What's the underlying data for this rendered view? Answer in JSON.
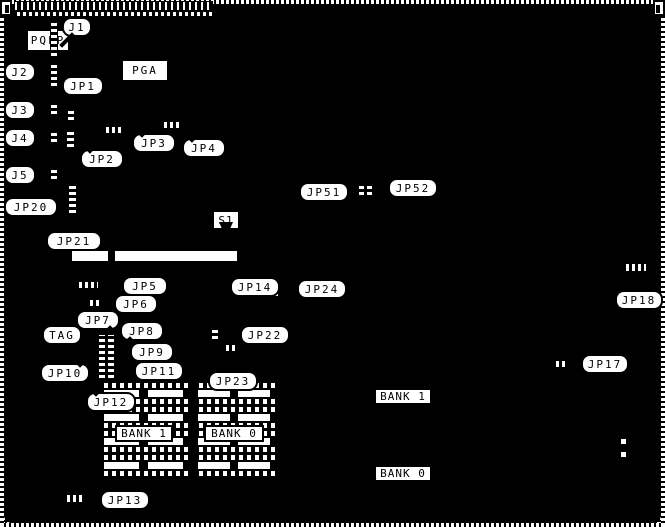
{
  "board": {
    "model": "MH1390"
  },
  "chips": {
    "pga": "PGA",
    "pqfp": "PQFP",
    "bios": "BIOS",
    "kbd": "KBD"
  },
  "bank_labels": [
    {
      "id": "bank1-dip",
      "text": "BANK 1",
      "x": 115,
      "y": 425,
      "w": 58,
      "h": 17
    },
    {
      "id": "bank0-dip",
      "text": "BANK 0",
      "x": 204,
      "y": 425,
      "w": 60,
      "h": 17
    },
    {
      "id": "bank1-simm",
      "text": "BANK 1",
      "x": 374,
      "y": 388,
      "w": 58,
      "h": 17
    },
    {
      "id": "bank0-simm",
      "text": "BANK 0",
      "x": 374,
      "y": 465,
      "w": 58,
      "h": 17
    }
  ],
  "callouts": [
    {
      "id": "j1",
      "text": "J1",
      "x": 62,
      "y": 17,
      "w": 30,
      "h": 20,
      "tail": "bl"
    },
    {
      "id": "j2",
      "text": "J2",
      "x": 4,
      "y": 62,
      "w": 32,
      "h": 20,
      "tail": "r"
    },
    {
      "id": "j3",
      "text": "J3",
      "x": 4,
      "y": 100,
      "w": 32,
      "h": 20,
      "tail": "r"
    },
    {
      "id": "j4",
      "text": "J4",
      "x": 4,
      "y": 128,
      "w": 32,
      "h": 20,
      "tail": "r"
    },
    {
      "id": "j5",
      "text": "J5",
      "x": 4,
      "y": 165,
      "w": 32,
      "h": 20,
      "tail": "r"
    },
    {
      "id": "jp1",
      "text": "JP1",
      "x": 62,
      "y": 76,
      "w": 42,
      "h": 20,
      "tail": "b"
    },
    {
      "id": "jp2",
      "text": "JP2",
      "x": 80,
      "y": 149,
      "w": 44,
      "h": 20,
      "tail": "tl"
    },
    {
      "id": "jp3",
      "text": "JP3",
      "x": 132,
      "y": 133,
      "w": 44,
      "h": 20,
      "tail": "tl"
    },
    {
      "id": "jp4",
      "text": "JP4",
      "x": 182,
      "y": 138,
      "w": 44,
      "h": 20,
      "tail": "tl"
    },
    {
      "id": "jp20",
      "text": "JP20",
      "x": 4,
      "y": 197,
      "w": 54,
      "h": 20,
      "tail": "r"
    },
    {
      "id": "jp21",
      "text": "JP21",
      "x": 46,
      "y": 231,
      "w": 56,
      "h": 20,
      "tail": "t"
    },
    {
      "id": "s1",
      "text": "S1",
      "x": 212,
      "y": 210,
      "w": 28,
      "h": 20,
      "tail": "b",
      "style": "box"
    },
    {
      "id": "jp5",
      "text": "JP5",
      "x": 122,
      "y": 276,
      "w": 46,
      "h": 20,
      "tail": "l"
    },
    {
      "id": "jp6",
      "text": "JP6",
      "x": 114,
      "y": 294,
      "w": 44,
      "h": 20,
      "tail": "l"
    },
    {
      "id": "jp7",
      "text": "JP7",
      "x": 76,
      "y": 310,
      "w": 44,
      "h": 20,
      "tail": "br"
    },
    {
      "id": "tag",
      "text": "TAG",
      "x": 42,
      "y": 325,
      "w": 40,
      "h": 20
    },
    {
      "id": "jp8",
      "text": "JP8",
      "x": 120,
      "y": 321,
      "w": 44,
      "h": 20,
      "tail": "bl"
    },
    {
      "id": "jp9",
      "text": "JP9",
      "x": 130,
      "y": 342,
      "w": 44,
      "h": 20,
      "tail": "l"
    },
    {
      "id": "jp10",
      "text": "JP10",
      "x": 40,
      "y": 363,
      "w": 50,
      "h": 20,
      "tail": "tr"
    },
    {
      "id": "jp11",
      "text": "JP11",
      "x": 134,
      "y": 361,
      "w": 50,
      "h": 20,
      "tail": "l"
    },
    {
      "id": "jp12",
      "text": "JP12",
      "x": 86,
      "y": 392,
      "w": 50,
      "h": 20,
      "tail": "tl"
    },
    {
      "id": "jp13",
      "text": "JP13",
      "x": 100,
      "y": 490,
      "w": 50,
      "h": 20,
      "tail": "l"
    },
    {
      "id": "jp14",
      "text": "JP14",
      "x": 230,
      "y": 277,
      "w": 50,
      "h": 20,
      "tail": "r"
    },
    {
      "id": "jp22",
      "text": "JP22",
      "x": 240,
      "y": 325,
      "w": 50,
      "h": 20,
      "tail": "l"
    },
    {
      "id": "jp23",
      "text": "JP23",
      "x": 208,
      "y": 371,
      "w": 50,
      "h": 20,
      "tail": "t"
    },
    {
      "id": "jp24",
      "text": "JP24",
      "x": 297,
      "y": 279,
      "w": 50,
      "h": 20,
      "tail": "l"
    },
    {
      "id": "jp51",
      "text": "JP51",
      "x": 299,
      "y": 182,
      "w": 50,
      "h": 20,
      "tail": "r"
    },
    {
      "id": "jp52",
      "text": "JP52",
      "x": 388,
      "y": 178,
      "w": 50,
      "h": 20,
      "tail": "l"
    },
    {
      "id": "jp17",
      "text": "JP17",
      "x": 581,
      "y": 354,
      "w": 48,
      "h": 20,
      "tail": "l"
    },
    {
      "id": "jp18",
      "text": "JP18",
      "x": 615,
      "y": 290,
      "w": 48,
      "h": 20,
      "tail": "t"
    }
  ]
}
